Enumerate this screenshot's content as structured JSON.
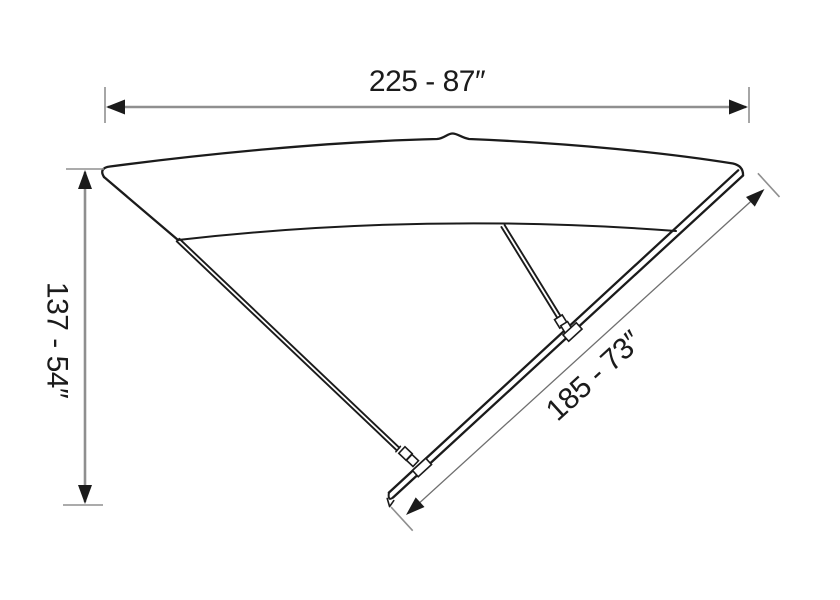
{
  "figure": {
    "labels": {
      "width": "225 - 87″",
      "height": "137 - 54″",
      "diagonal": "185 - 73″"
    },
    "colors": {
      "line": "#1b1b1b",
      "dimension": "#8f8f8f",
      "dimension_thin": "#6f6f6f",
      "text": "#1b1b1b",
      "background": "#ffffff"
    }
  }
}
